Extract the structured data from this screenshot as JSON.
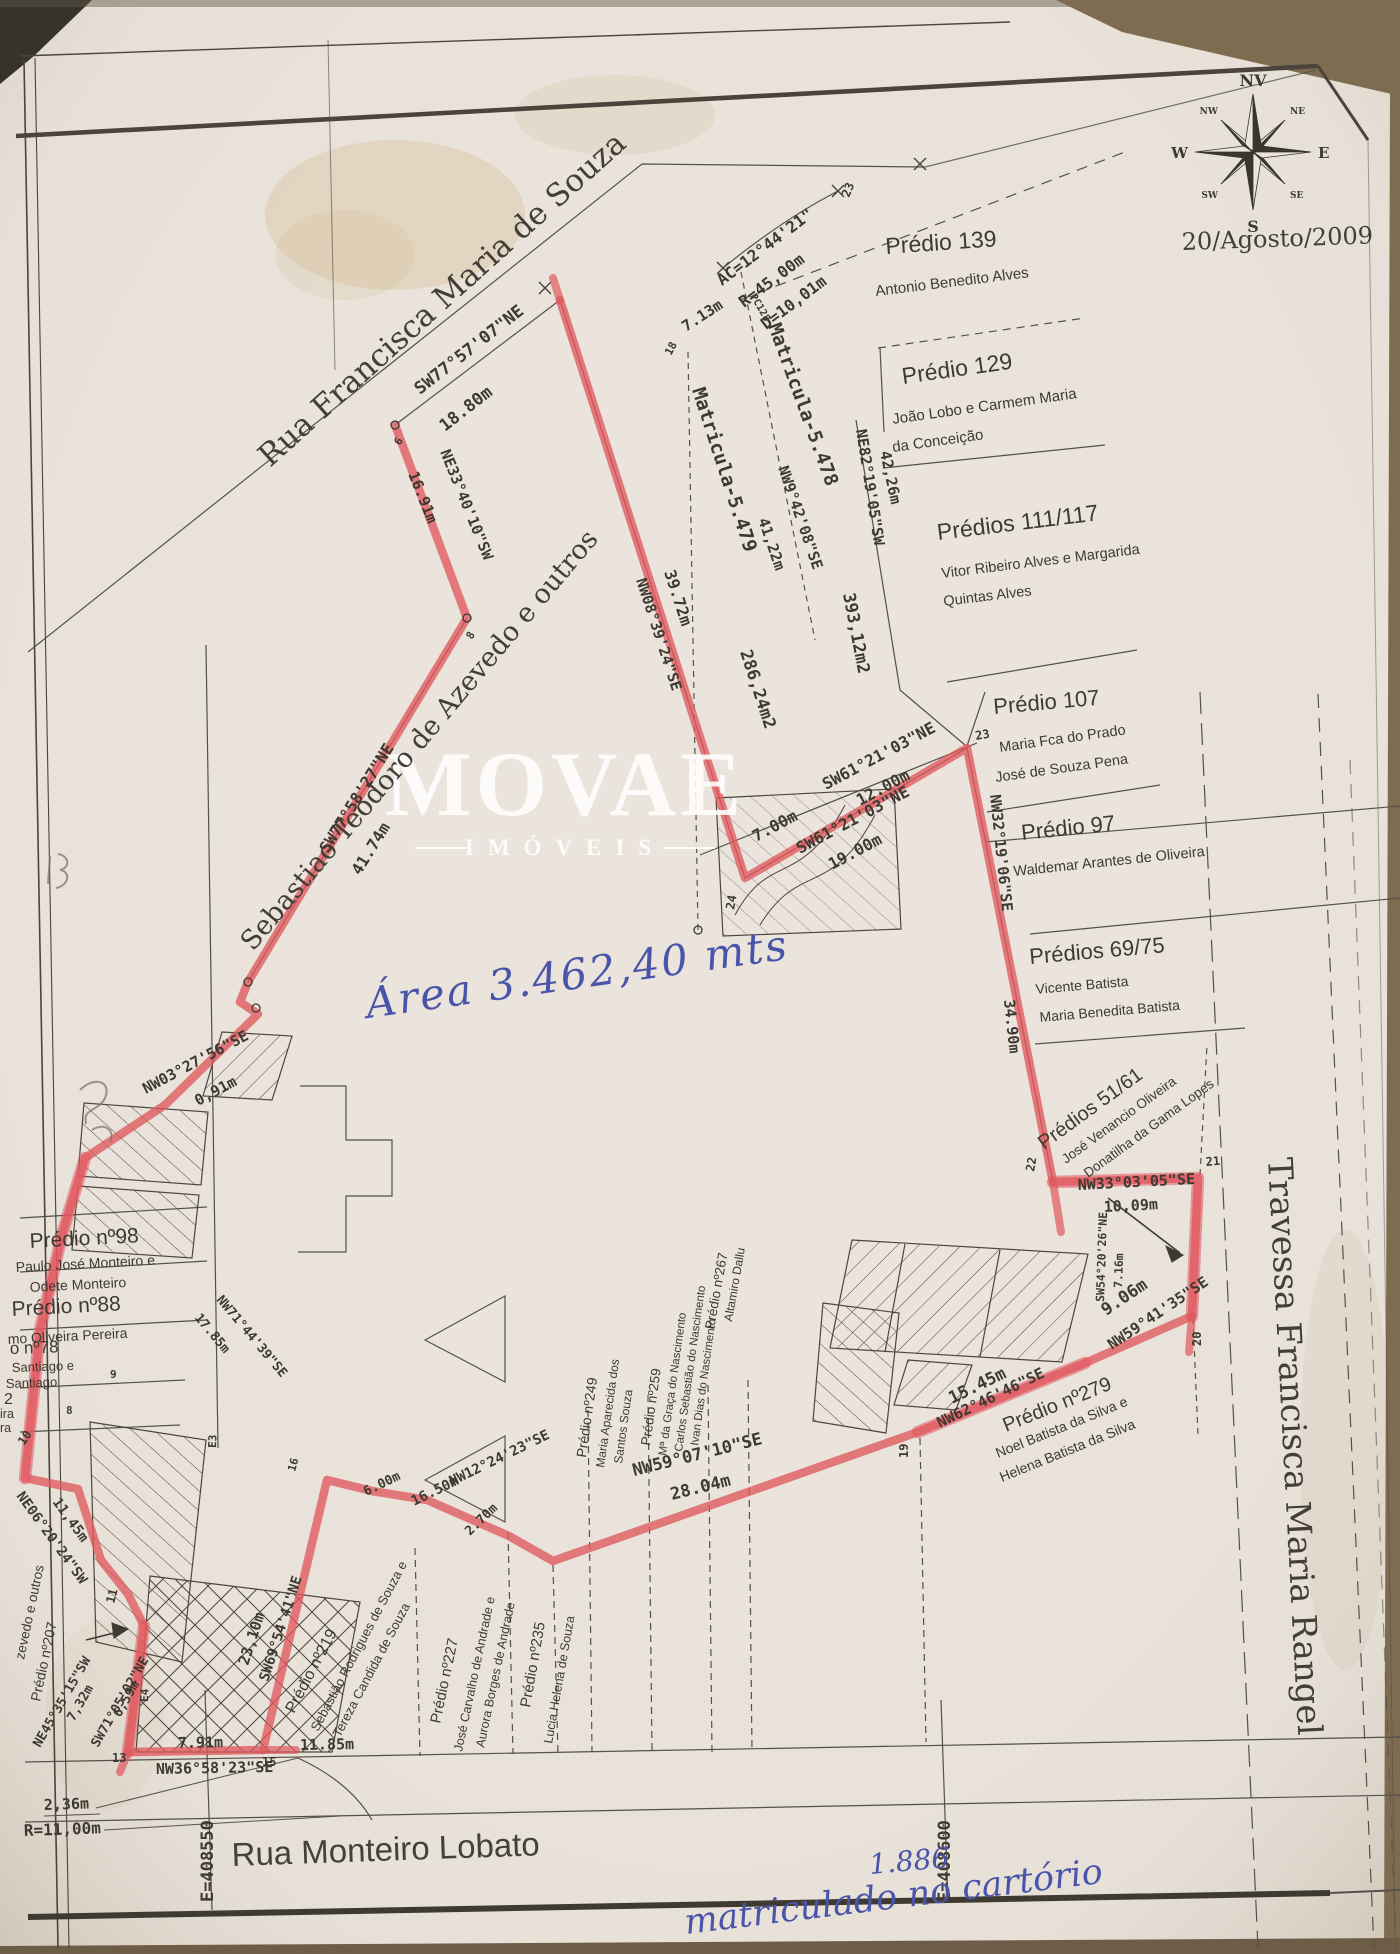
{
  "meta": {
    "date": "20/Agosto/2009"
  },
  "watermark": {
    "brand": "MOVAE",
    "subtitle": "IMÓVEIS"
  },
  "compass": {
    "n": "NV",
    "s": "S",
    "e": "E",
    "w": "W",
    "ne": "NE",
    "nw": "NW",
    "se": "SE",
    "sw": "SW"
  },
  "streets": {
    "top": "Rua Francisca Maria de Souza",
    "right": "Travessa Francisca Maria Rangel",
    "bottom": "Rua Monteiro Lobato",
    "owner_left": "Sebastiao Teodoro de Azevedo e outros"
  },
  "coordinates": {
    "e1": "E=408550",
    "e2": "E=408600"
  },
  "handwriting": {
    "area_note": "Área 3.462,40 mts",
    "registry_number": "1.886",
    "registry_note": "matriculado no cartório"
  },
  "matriculas": {
    "m5478": "Matricula-5.478",
    "m5479": "Matricula-5.479",
    "pc": "PC128"
  },
  "areas": {
    "a1": "393,12m2",
    "a2": "286,24m2"
  },
  "arc": {
    "ac": "AC=12°44'21\"",
    "r": "R=45,00m",
    "d": "D=10,01m"
  },
  "parcels": {
    "p139": {
      "title": "Prédio 139",
      "owner1": "Antonio Benedito Alves"
    },
    "p129": {
      "title": "Prédio 129",
      "owner1": "João Lobo e Carmem Maria",
      "owner2": "da Conceição"
    },
    "p111": {
      "title": "Prédios 111/117",
      "owner1": "Vitor Ribeiro Alves e Margarida",
      "owner2": "Quintas Alves"
    },
    "p107": {
      "title": "Prédio 107",
      "owner1": "Maria Fca do Prado",
      "owner2": "José de Souza Pena"
    },
    "p97": {
      "title": "Prédio 97",
      "owner1": "Waldemar Arantes de Oliveira"
    },
    "p69": {
      "title": "Prédios 69/75",
      "owner1": "Vicente Batista",
      "owner2": "Maria Benedita Batista"
    },
    "p51": {
      "title": "Prédios 51/61",
      "owner1": "José Venancio Oliveira",
      "owner2": "Donatilha da Gama Lopes"
    },
    "p279": {
      "title": "Prédio nº279",
      "owner1": "Noel Batista da Silva e",
      "owner2": "Helena Batista da Silva"
    },
    "p98": {
      "title": "Prédio nº98",
      "owner1": "Paulo José Monteiro e",
      "owner2": "Odete Monteiro"
    },
    "p88": {
      "title": "Prédio nº88",
      "owner1": "mo Oliveira Pereira"
    },
    "p78": {
      "title": "o nº78",
      "owner1": "Santiago e",
      "owner2": "Santiago"
    },
    "p207": {
      "title": "Prédio nº207"
    },
    "outros": {
      "title": "zevedo e outros"
    },
    "p219": {
      "title": "Prédio nº219",
      "owner1": "Sebastião Rodrigues de Souza e",
      "owner2": "Tereza Candida de Souza"
    },
    "p227": {
      "title": "Prédio nº227",
      "owner1": "José Carvalho de Andrade e",
      "owner2": "Aurora Borges de Andrade"
    },
    "p235": {
      "title": "Prédio nº235",
      "owner1": "Lucia Helena de Souza"
    },
    "p249": {
      "title": "Prédio nº249",
      "owner1": "Maria Aparecida dos",
      "owner2": "Santos Souza"
    },
    "p259": {
      "title": "Prédio nº259",
      "owner1": "Mª da Graça do Nascimento",
      "owner2": "Carlos Sebastião do Nascimento",
      "owner3": "Ivan Dias do Nascimento"
    },
    "p267": {
      "title": "Prédio nº267",
      "owner1": "Altamiro Dallu"
    },
    "partials": {
      "a": "2",
      "b": "ira",
      "c": "ra"
    }
  },
  "bearings": {
    "seg_top": {
      "b": "SW77°57'07\"NE",
      "d": "18.80m"
    },
    "seg_713": {
      "d": "7.13m"
    },
    "seg_3972": {
      "b": "NW08°39'24\"SE",
      "d": "39.72m"
    },
    "seg_4122": {
      "b": "NW9°42'08\"SE",
      "d": "41,22m"
    },
    "seg_4226": {
      "b": "NE82°19'05\"SW",
      "d": "42,26m"
    },
    "seg_12": {
      "b": "SW61°21'03\"NE",
      "d": "12.00m"
    },
    "seg_7": {
      "d": "7.00m"
    },
    "seg_19": {
      "b": "SW61°21'03\"NE",
      "d": "19.00m"
    },
    "seg_3490": {
      "b": "NW32°19'06\"SE",
      "d": "34.90m"
    },
    "seg_1009": {
      "b": "NW33°03'05\"SE",
      "d": "10,09m"
    },
    "seg_716": {
      "b": "SW54°20'26\"NE",
      "d": "7.16m"
    },
    "seg_906": {
      "b": "NW59°41'35\"SE",
      "d": "9.06m"
    },
    "seg_1545": {
      "b": "NW62°46'46\"SE",
      "d": "15.45m"
    },
    "seg_2804": {
      "b": "NW59°07'10\"SE",
      "d": "28.04m"
    },
    "seg_1650": {
      "b": "NW12°24'23\"SE",
      "d": "16.50m"
    },
    "seg_600": {
      "d": "6.00m"
    },
    "seg_270": {
      "d": "2.70m"
    },
    "seg_2310": {
      "b": "SW69°54'41\"NE",
      "d": "23,10m"
    },
    "seg_1185": {
      "d": "11.85m"
    },
    "seg_791": {
      "d": "7.91m"
    },
    "seg_3658": {
      "b": "NW36°58'23\"SE"
    },
    "seg_732": {
      "b": "NE45°35'15\"SW",
      "d": "7,32m"
    },
    "seg_659": {
      "b": "SW71°05'02\"NE",
      "d": "6,59m"
    },
    "seg_1145": {
      "b": "NE06°20'24\"SW",
      "d": "11,45m"
    },
    "seg_1785": {
      "b": "NW71°44'39\"SE",
      "d": "17.85m"
    },
    "seg_091": {
      "b": "NW03°27'56\"SE",
      "d": "0,91m"
    },
    "seg_4174": {
      "b": "SW77°58'27\"NE",
      "d": "41.74m"
    },
    "seg_1691": {
      "b": "NE33°40'10\"SW",
      "d": "16.91m"
    },
    "seg_236": {
      "d": "2,36m"
    },
    "seg_r11": {
      "d": "R=11,00m"
    }
  },
  "vertices": {
    "v6": "6",
    "v8": "8",
    "v9": "9",
    "v10": "10",
    "v11": "11",
    "v13": "13",
    "v15": "15",
    "v16": "16",
    "v18": "18",
    "v19": "19",
    "v20": "20",
    "v21": "21",
    "v22": "22",
    "v23": "23",
    "v24": "24",
    "e3": "E3",
    "e4": "E4"
  }
}
